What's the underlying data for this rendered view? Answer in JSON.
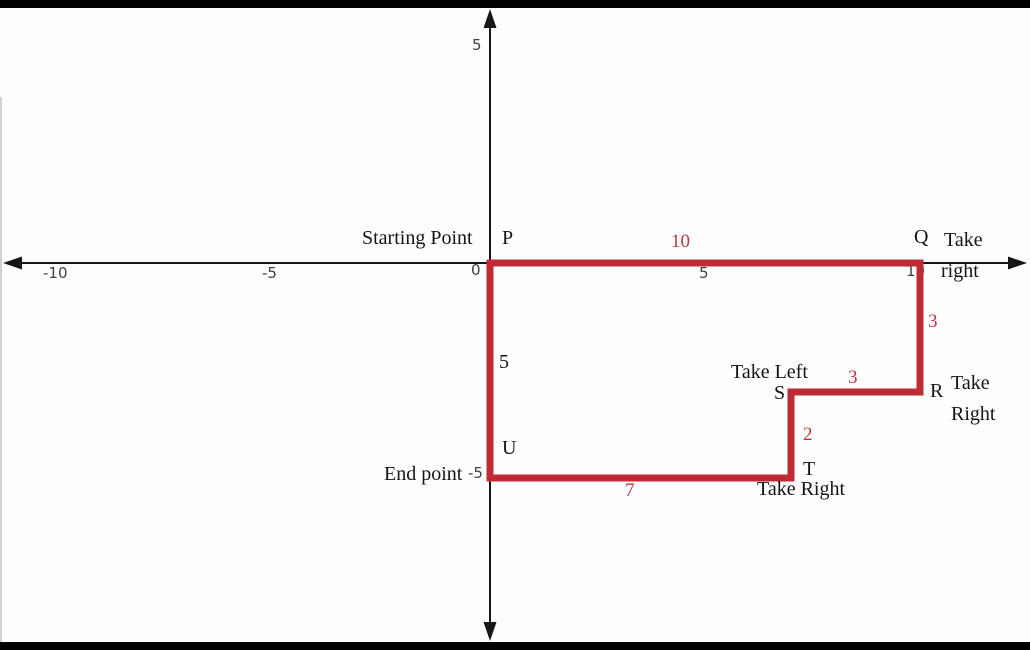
{
  "figure": {
    "background": "#fefefe",
    "path_color": "#bf2b35",
    "axis_color": "#161616",
    "tick_color": "#3f3f3f",
    "text_color": "#141414",
    "red_label_color": "#b5373f",
    "frame_bar_color": "#000000"
  },
  "chart_data": {
    "type": "path-diagram",
    "title": "",
    "closed": true,
    "points": [
      {
        "name": "P",
        "x": 0,
        "y": 0,
        "role": "Starting Point"
      },
      {
        "name": "Q",
        "x": 10,
        "y": 0,
        "direction": "Take right"
      },
      {
        "name": "R",
        "x": 10,
        "y": -3,
        "direction": "Take Right"
      },
      {
        "name": "S",
        "x": 7,
        "y": -3,
        "direction": "Take Left"
      },
      {
        "name": "T",
        "x": 7,
        "y": -5,
        "direction": "Take Right"
      },
      {
        "name": "U",
        "x": 0,
        "y": -5,
        "role": "End point"
      }
    ],
    "segment_lengths": {
      "PQ": 10,
      "QR": 3,
      "RS": 3,
      "ST": 2,
      "TU": 7,
      "UP": 5
    },
    "x_ticks": [
      -10,
      -5,
      0,
      5,
      10
    ],
    "y_ticks": [
      5,
      -5
    ],
    "grid": false
  },
  "ticks": {
    "x_neg10": "-10",
    "x_neg5": "-5",
    "x_0": "0",
    "x_5": "5",
    "x_10": "10",
    "y_5": "5",
    "y_neg5": "-5"
  },
  "labels": {
    "starting_point": "Starting Point",
    "p": "P",
    "q": "Q",
    "q_dir_line1": "Take",
    "q_dir_line2": "right",
    "r": "R",
    "r_dir_line1": "Take",
    "r_dir_line2": "Right",
    "s_dir": "Take Left",
    "s": "S",
    "t": "T",
    "t_dir": "Take Right",
    "u": "U",
    "end_point": "End point",
    "seg_pq": "10",
    "seg_qr": "3",
    "seg_rs": "3",
    "seg_st": "2",
    "seg_tu": "7",
    "seg_up": "5"
  }
}
